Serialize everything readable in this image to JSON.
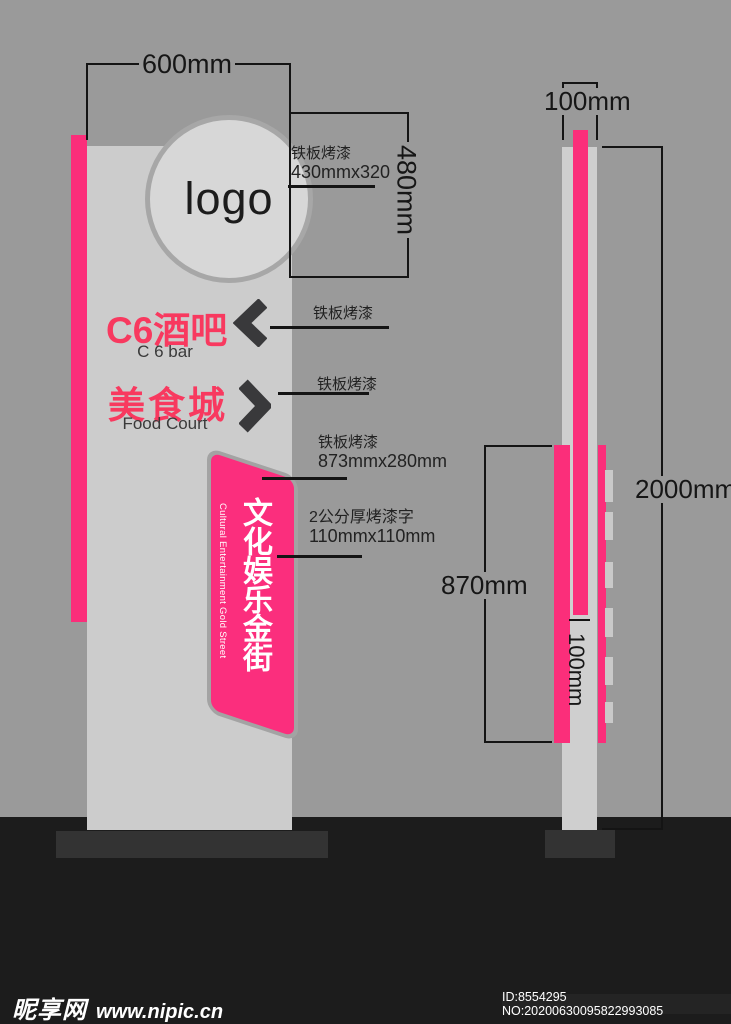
{
  "colors": {
    "background": "#9A9A9A",
    "tower": "#CCCCCC",
    "accent_pink": "#FB2E7A",
    "panel_pink": "#FB2E7D",
    "text_pink": "#F8395F",
    "chevron": "#39393B",
    "ground": "#1C1C1C",
    "base": "#333333"
  },
  "front_view": {
    "logo_text": "logo",
    "width_dim": "600mm",
    "header_height_dim": "480mm",
    "logo_note_line1": "铁板烤漆",
    "logo_note_line2": "430mmx320",
    "entries": [
      {
        "zh": "C6酒吧",
        "en": "C 6 bar",
        "note": "铁板烤漆",
        "direction": "left"
      },
      {
        "zh": "美食城",
        "en": "Food Court",
        "note": "铁板烤漆",
        "direction": "right"
      }
    ],
    "banner": {
      "zh_vertical": "文化娱乐金街",
      "en_vertical": "Cultural Entertainment Gold Street",
      "note1_line1": "铁板烤漆",
      "note1_line2": "873mmx280mm",
      "note2_line1": "2公分厚烤漆字",
      "note2_line2": "110mmx110mm"
    }
  },
  "side_view": {
    "depth_dim": "100mm",
    "total_height_dim": "2000mm",
    "panel_height_dim": "870mm",
    "stripe_width_dim": "100mm"
  },
  "watermark": {
    "site_name": "昵享网",
    "site_url": "www.nipic.cn",
    "id_text": "ID:8554295 NO:20200630095822993085"
  }
}
